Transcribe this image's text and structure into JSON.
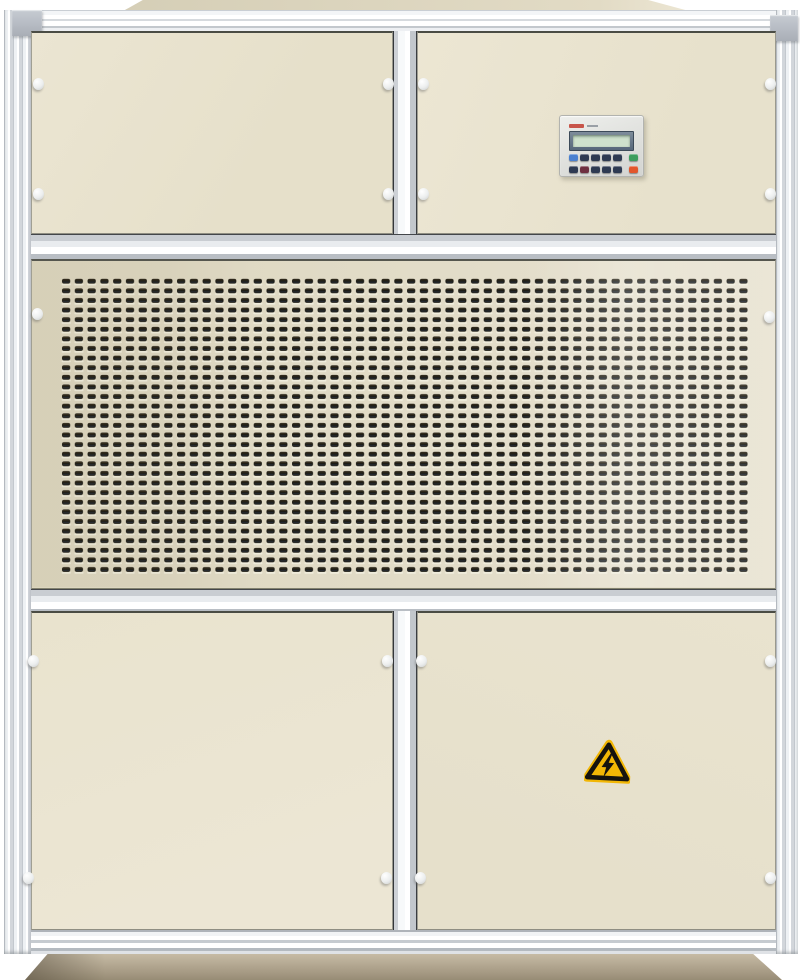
{
  "scene": {
    "type": "photograph",
    "subject": "Industrial air-handling / dehumidifier cabinet, front view",
    "background_color": "#ffffff"
  },
  "colors": {
    "panel_beige": "#e6e0ca",
    "panel_beige_light": "#ebe5d2",
    "grille_beige": "#dcd6bf",
    "cap_grey": "#b6bbc3",
    "slot_dark": "#1d1c15",
    "base_top": "#c6bba5",
    "base_bottom": "#978c75",
    "roof_beige": "#d5ceb6",
    "warn_yellow": "#f2b705",
    "lcd_screen": "#cfe2cd",
    "lcd_frame": "#56677a",
    "bezel_light": "#eeefec",
    "bezel_dark": "#d3d4d1",
    "brand_red": "#c23b2e"
  },
  "structure": {
    "sections": [
      "top-access-panel-left",
      "top-access-panel-right-with-controller",
      "perforated-intake-grille",
      "bottom-access-panel-left",
      "bottom-access-panel-right-with-warning-sign"
    ]
  },
  "grille": {
    "columns": 54,
    "rows": 31,
    "pitch_x": 12.78,
    "pitch_y": 9.61
  },
  "fasteners": {
    "count": 18,
    "positions": [
      [
        38,
        84
      ],
      [
        388,
        84
      ],
      [
        423,
        84
      ],
      [
        770,
        84
      ],
      [
        38,
        194
      ],
      [
        388,
        194
      ],
      [
        423,
        194
      ],
      [
        770,
        194
      ],
      [
        37,
        314
      ],
      [
        769,
        317
      ],
      [
        33,
        661
      ],
      [
        387,
        661
      ],
      [
        421,
        661
      ],
      [
        770,
        661
      ],
      [
        28,
        878
      ],
      [
        386,
        878
      ],
      [
        420,
        878
      ],
      [
        770,
        878
      ]
    ]
  },
  "controller": {
    "display": "blank-lcd",
    "button_rows": [
      [
        "#4a80d0",
        "#2e3a52",
        "#2e3a52",
        "#2e3a52",
        "#2e3a52",
        "#3d9e5e"
      ],
      [
        "#2e3a52",
        "#6e2f40",
        "#2e3a52",
        "#2e3a52",
        "#2e3a52",
        "#e2562c"
      ]
    ]
  },
  "warning_sign": {
    "symbol": "high-voltage-lightning",
    "background": "#f2b705",
    "border": "#15130e"
  }
}
